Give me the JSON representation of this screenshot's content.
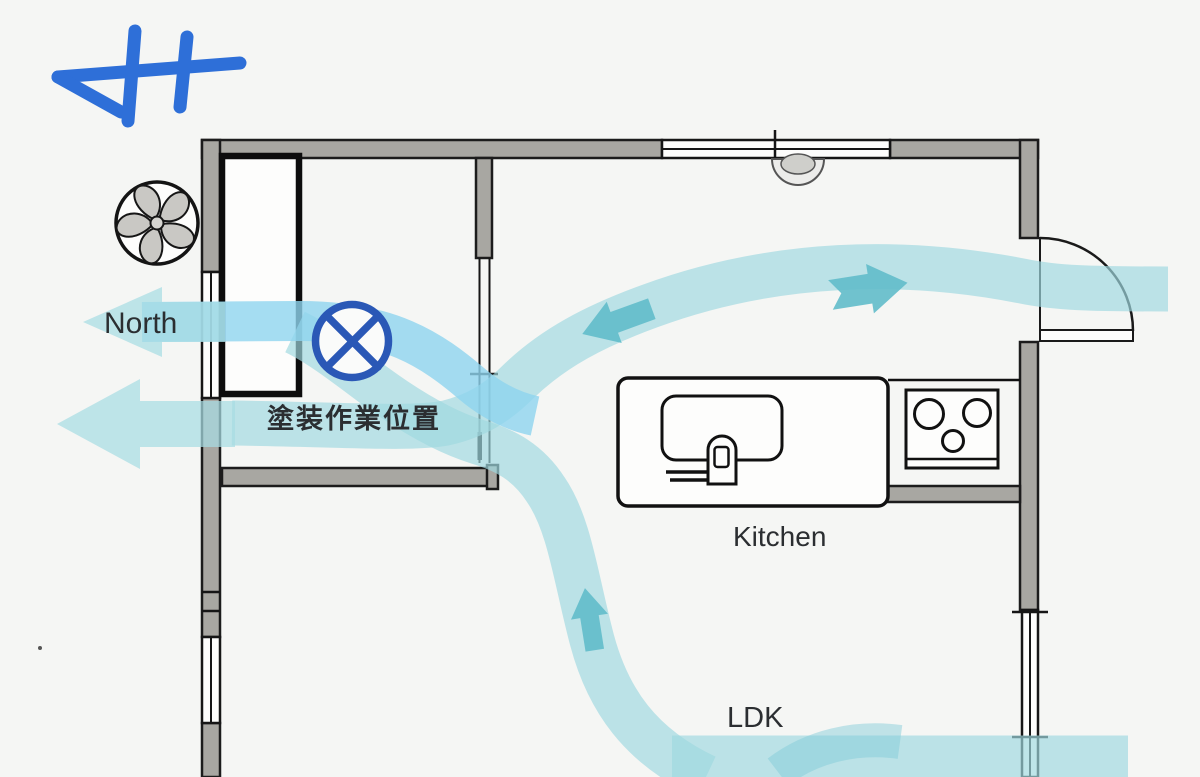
{
  "page": {
    "type": "floor-plan-airflow-diagram"
  },
  "labels": {
    "north": "North",
    "paint_work_position": "塗装作業位置",
    "kitchen": "Kitchen",
    "ldk": "LDK"
  },
  "icons": {
    "fan": "ventilation-fan-icon",
    "paint_position_marker": "circled-x-marker-icon",
    "north_arrow": "hand-drawn-north-arrow-icon",
    "ceiling_fixture": "dome-sensor-icon",
    "stove": "three-burner-stove-symbol",
    "sink": "kitchen-sink-symbol",
    "door": "door-swing-arc-symbol"
  },
  "airflow": {
    "band_color": "#9fd9e0",
    "exhaust_stream_color": "#8ed5ef",
    "arrow_color": "#62bcca",
    "arrows": [
      {
        "id": "exhaust-out-upper",
        "direction": "left"
      },
      {
        "id": "exhaust-out-lower",
        "direction": "left"
      },
      {
        "id": "kitchen-to-paint-room",
        "direction": "down-left"
      },
      {
        "id": "entry-door-inflow",
        "direction": "up-right"
      },
      {
        "id": "ldk-rising",
        "direction": "up"
      }
    ]
  },
  "colors": {
    "background": "#f5f6f4",
    "wall_fill": "#a8a7a2",
    "outline": "#1c1c1c",
    "annotation_blue": "#2a58b6",
    "sketch_blue": "#2e6fd8",
    "label_text": "#2b2e31"
  }
}
